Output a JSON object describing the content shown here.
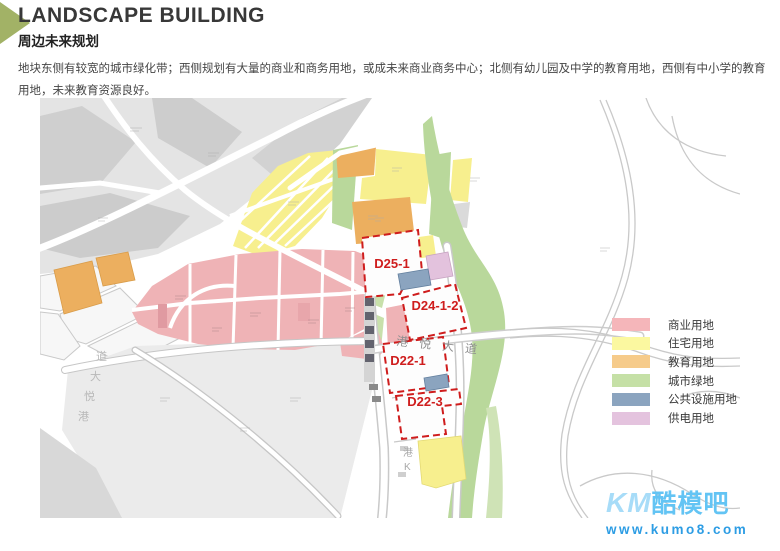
{
  "header": {
    "title": "LANDSCAPE BUILDING",
    "subtitle": "周边未来规划"
  },
  "description": "地块东侧有较宽的城市绿化带；西侧规划有大量的商业和商务用地，或成未来商业商务中心；北侧有幼儿园及中学的教育用地，西侧有中小学的教育用地，未来教育资源良好。",
  "map": {
    "outline_color": "#cf1d1d",
    "parcels": [
      {
        "label": "D25-1"
      },
      {
        "label": "D24-1-2"
      },
      {
        "label": "D22-1"
      },
      {
        "label": "D22-3"
      }
    ],
    "roads": [
      {
        "label": "港悦大道"
      },
      {
        "chars": [
          "港",
          "悦",
          "大",
          "道"
        ]
      },
      {
        "chars": [
          "港",
          "K"
        ]
      }
    ]
  },
  "legend": {
    "items": [
      {
        "label": "商业用地",
        "color": "#f5b6ba"
      },
      {
        "label": "住宅用地",
        "color": "#fbf8a0"
      },
      {
        "label": "教育用地",
        "color": "#f6cb8a"
      },
      {
        "label": "城市绿地",
        "color": "#c5e0a6"
      },
      {
        "label": "公共设施用地",
        "color": "#8ba4bf"
      },
      {
        "label": "供电用地",
        "color": "#e4c3de"
      }
    ]
  },
  "watermark": {
    "logo_latin": "KM",
    "logo_cjk": "酷模吧",
    "url": "www.kumo8.com",
    "colors": {
      "logo_latin": "#a7dcf8",
      "logo_cjk": "#63c4f4",
      "url": "#2d9de4"
    }
  }
}
